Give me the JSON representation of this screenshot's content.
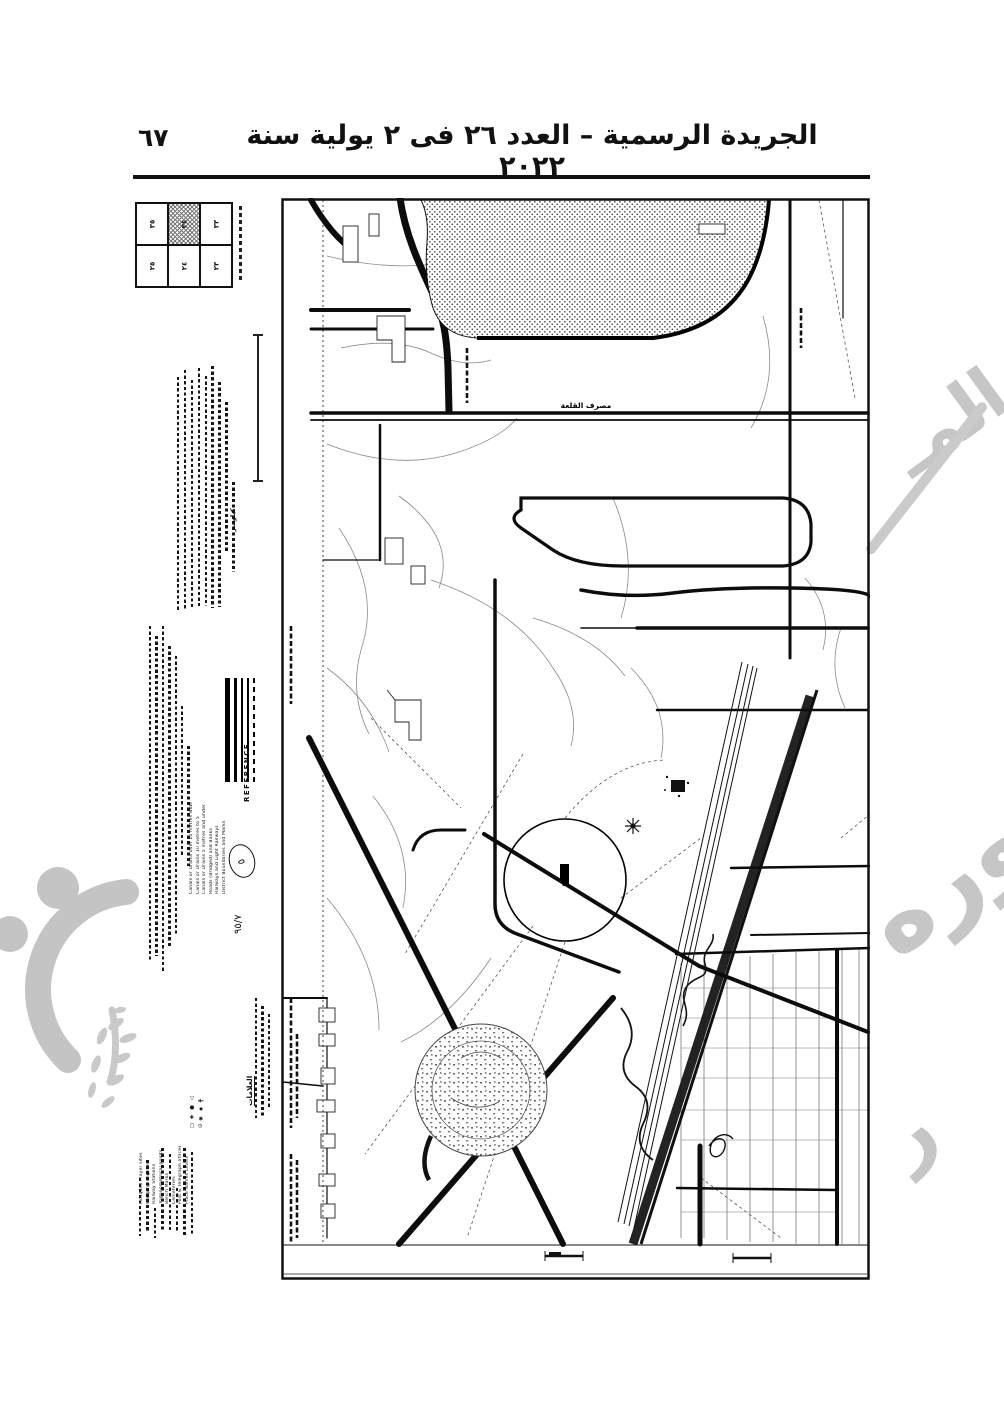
{
  "header": {
    "page_number": "٦٧",
    "title": "الجريدة الرسمية – العدد ٢٦ فى ٢ يولية سنة ٢٠٢٢"
  },
  "map": {
    "labels": {
      "drain": "مصرف القلعة"
    },
    "margin": {
      "index_grid": {
        "cells": [
          "٣٥",
          "٣٤",
          "٣٣",
          "٢٥",
          "٢٤",
          "٢٣"
        ]
      },
      "scale_label": "كيلومتر",
      "reference": {
        "title": "REFERENCE",
        "entries": [
          "Canals or Drains over 10 metres wide",
          "Canals or Drains 10 metres to 5",
          "Canals or Drains 5 metres and under",
          "Roads (Bridged) and Banks",
          "Railways and Light Railways",
          "District Boundaries and Marks"
        ],
        "annotation_mark": "٥",
        "annotation": "٩٥/٧"
      },
      "symbols": {
        "title": "العلامات",
        "glyphs": [
          "◻",
          "✚",
          "●",
          "△",
          "⊙",
          "✱",
          "▪",
          "╋"
        ],
        "entries": [
          "Mosques Prayer sites",
          "Pumping Engines",
          "Railway Stations",
          "Trigonometrical points",
          "Bench Marks",
          "Cemeteries",
          "Post & Telegraph offices",
          "Place Names Levels"
        ]
      }
    }
  },
  "watermarks": {
    "stamp_fragment_top": "المـ",
    "stamp_fragment_main": "صوره",
    "stamp_fragment_tail": "ر",
    "color": "#c6c6c6"
  }
}
